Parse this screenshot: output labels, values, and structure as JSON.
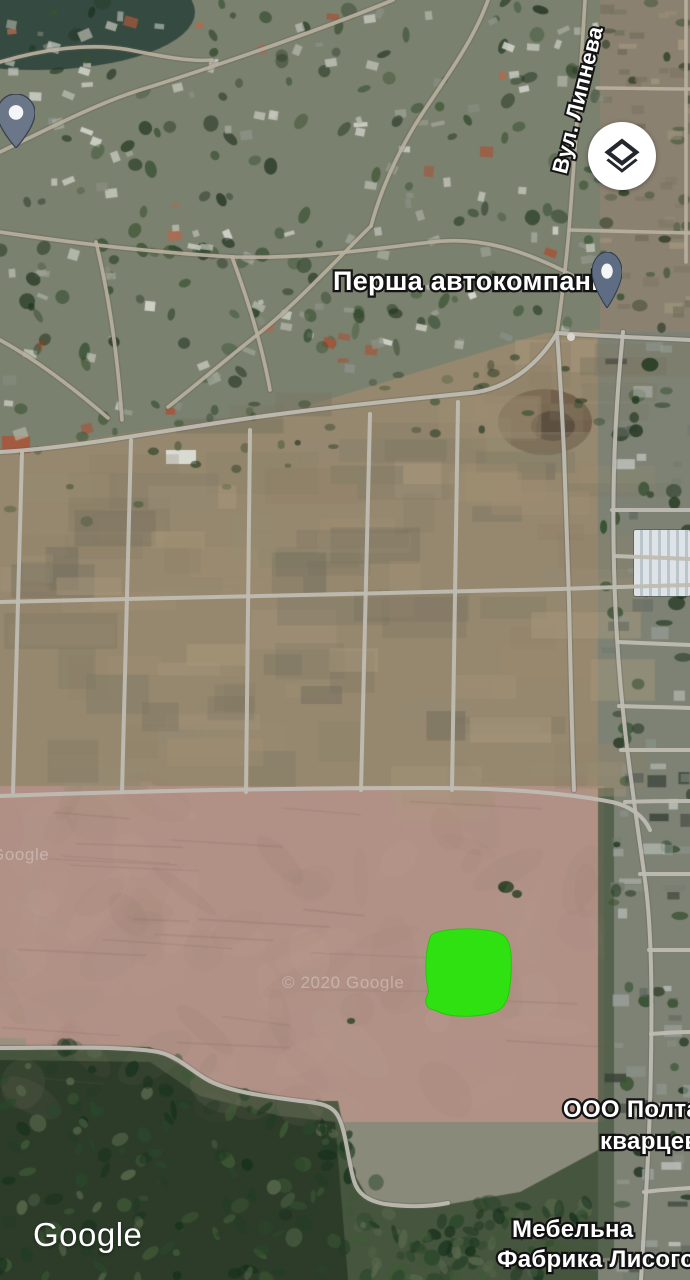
{
  "app": {
    "type": "satellite-map-view"
  },
  "branding": {
    "logo": "Google",
    "watermark": "© 2020 Google"
  },
  "controls": {
    "layers_button": {
      "aria": "Layers",
      "icon": "layers-icon"
    }
  },
  "labels": {
    "street_vertical": "Вул. Липнева",
    "poi_primary": "Перша автокомпанія",
    "poi_right_line1": "ООО Полтав",
    "poi_right_line2": "кварцев",
    "poi_bottom_line1": "Мебельна",
    "poi_bottom_line2": "Фабрика Лисого"
  },
  "markers": {
    "pin_top_left": {
      "icon": "map-pin-icon",
      "color": "#6B7689"
    },
    "pin_poi": {
      "icon": "map-pin-icon",
      "color": "#5E6D83"
    }
  },
  "highlight": {
    "name": "selected-land-plot",
    "color": "#2BE30E",
    "stroke": "#27C50C"
  }
}
